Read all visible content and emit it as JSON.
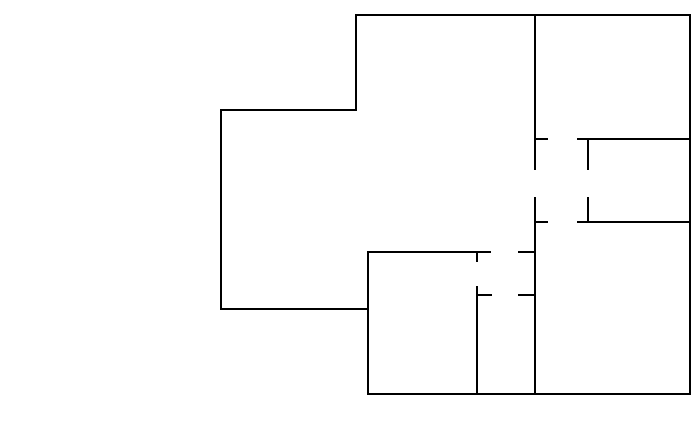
{
  "canvas": {
    "width": 700,
    "height": 446,
    "background_color": "#ffffff"
  },
  "floor_plan": {
    "stroke_color": "#000000",
    "stroke_width": 2,
    "walls": [
      {
        "name": "outer-top-wall",
        "x1": 355,
        "y1": 15,
        "x2": 691,
        "y2": 15
      },
      {
        "name": "outer-right-wall",
        "x1": 690,
        "y1": 14,
        "x2": 690,
        "y2": 395
      },
      {
        "name": "outer-bottom-wall",
        "x1": 367,
        "y1": 394,
        "x2": 691,
        "y2": 394
      },
      {
        "name": "outer-lower-left-wall",
        "x1": 368,
        "y1": 252,
        "x2": 368,
        "y2": 395
      },
      {
        "name": "left-wing-bottom-wall",
        "x1": 220,
        "y1": 309,
        "x2": 369,
        "y2": 309
      },
      {
        "name": "left-wing-left-wall",
        "x1": 221,
        "y1": 109,
        "x2": 221,
        "y2": 310
      },
      {
        "name": "left-wing-top-wall",
        "x1": 220,
        "y1": 110,
        "x2": 357,
        "y2": 110
      },
      {
        "name": "upper-left-wall",
        "x1": 356,
        "y1": 14,
        "x2": 356,
        "y2": 111
      },
      {
        "name": "hallway-wall-upper",
        "x1": 535,
        "y1": 14,
        "x2": 535,
        "y2": 170
      },
      {
        "name": "hallway-wall-lower",
        "x1": 535,
        "y1": 197,
        "x2": 535,
        "y2": 395
      },
      {
        "name": "hallway-door-jamb-upper",
        "x1": 535,
        "y1": 139,
        "x2": 548,
        "y2": 139
      },
      {
        "name": "hallway-door-jamb-lower",
        "x1": 535,
        "y1": 222,
        "x2": 548,
        "y2": 222
      },
      {
        "name": "right-rooms-divider-upper",
        "x1": 577,
        "y1": 139,
        "x2": 690,
        "y2": 139
      },
      {
        "name": "right-rooms-divider-lower",
        "x1": 577,
        "y1": 222,
        "x2": 690,
        "y2": 222
      },
      {
        "name": "right-room-stub-upper",
        "x1": 588,
        "y1": 139,
        "x2": 588,
        "y2": 170
      },
      {
        "name": "right-room-stub-lower",
        "x1": 588,
        "y1": 197,
        "x2": 588,
        "y2": 223
      },
      {
        "name": "center-room-top-wall-left",
        "x1": 367,
        "y1": 252,
        "x2": 491,
        "y2": 252
      },
      {
        "name": "center-room-top-wall-right",
        "x1": 518,
        "y1": 252,
        "x2": 536,
        "y2": 252
      },
      {
        "name": "bottom-room-divider-jamb",
        "x1": 477,
        "y1": 252,
        "x2": 477,
        "y2": 262
      },
      {
        "name": "bottom-room-divider-wall",
        "x1": 477,
        "y1": 286,
        "x2": 477,
        "y2": 395
      },
      {
        "name": "bottom-room-inner-wall-left",
        "x1": 477,
        "y1": 295,
        "x2": 492,
        "y2": 295
      },
      {
        "name": "bottom-room-inner-wall-right",
        "x1": 518,
        "y1": 295,
        "x2": 536,
        "y2": 295
      }
    ]
  }
}
